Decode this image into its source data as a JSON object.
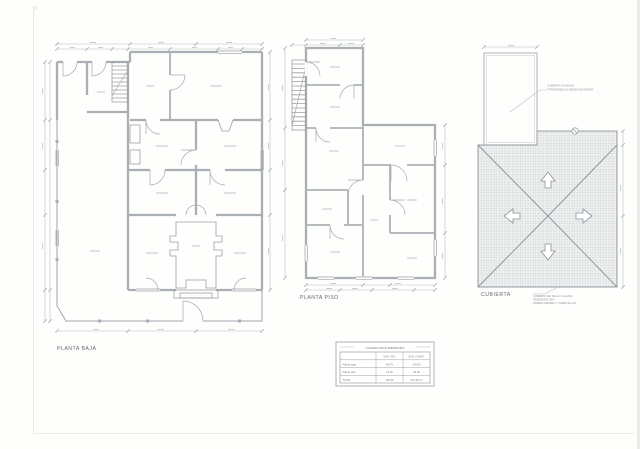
{
  "sheet": {
    "background": "#fefefd",
    "line_color": "#9fa5ab",
    "wall_color": "#a9afb4",
    "hatch_color": "#bfc4c7"
  },
  "drawings": {
    "planta_baja": {
      "label": "PLANTA BAJA"
    },
    "planta_piso": {
      "label": "PLANTA PISO"
    },
    "cubierta": {
      "label": "CUBIERTA",
      "slope_arrows": [
        "up",
        "down",
        "left",
        "right"
      ],
      "note_top": [
        "CUBIERTA PLANA NO",
        "TRANSITABLE ACABADO EN GRAVA"
      ],
      "note_bottom": [
        "CUBIERTA DE TEJA A 4 AGUAS",
        "PENDIENTE 30%",
        "SOBRE TABLERO Y TABIQUILLOS"
      ]
    }
  },
  "table": {
    "title": "CUADRO DE SUPERFICIES",
    "col_headers": [
      "SUP. ÚTIL",
      "SUP. CONST."
    ],
    "rows": [
      {
        "label": "Planta baja",
        "util": "84.75",
        "const": "103.60"
      },
      {
        "label": "Planta piso",
        "util": "76.20",
        "const": "94.35"
      },
      {
        "label": "TOTAL",
        "util": "160.95",
        "const": "197.95 m²"
      }
    ]
  }
}
